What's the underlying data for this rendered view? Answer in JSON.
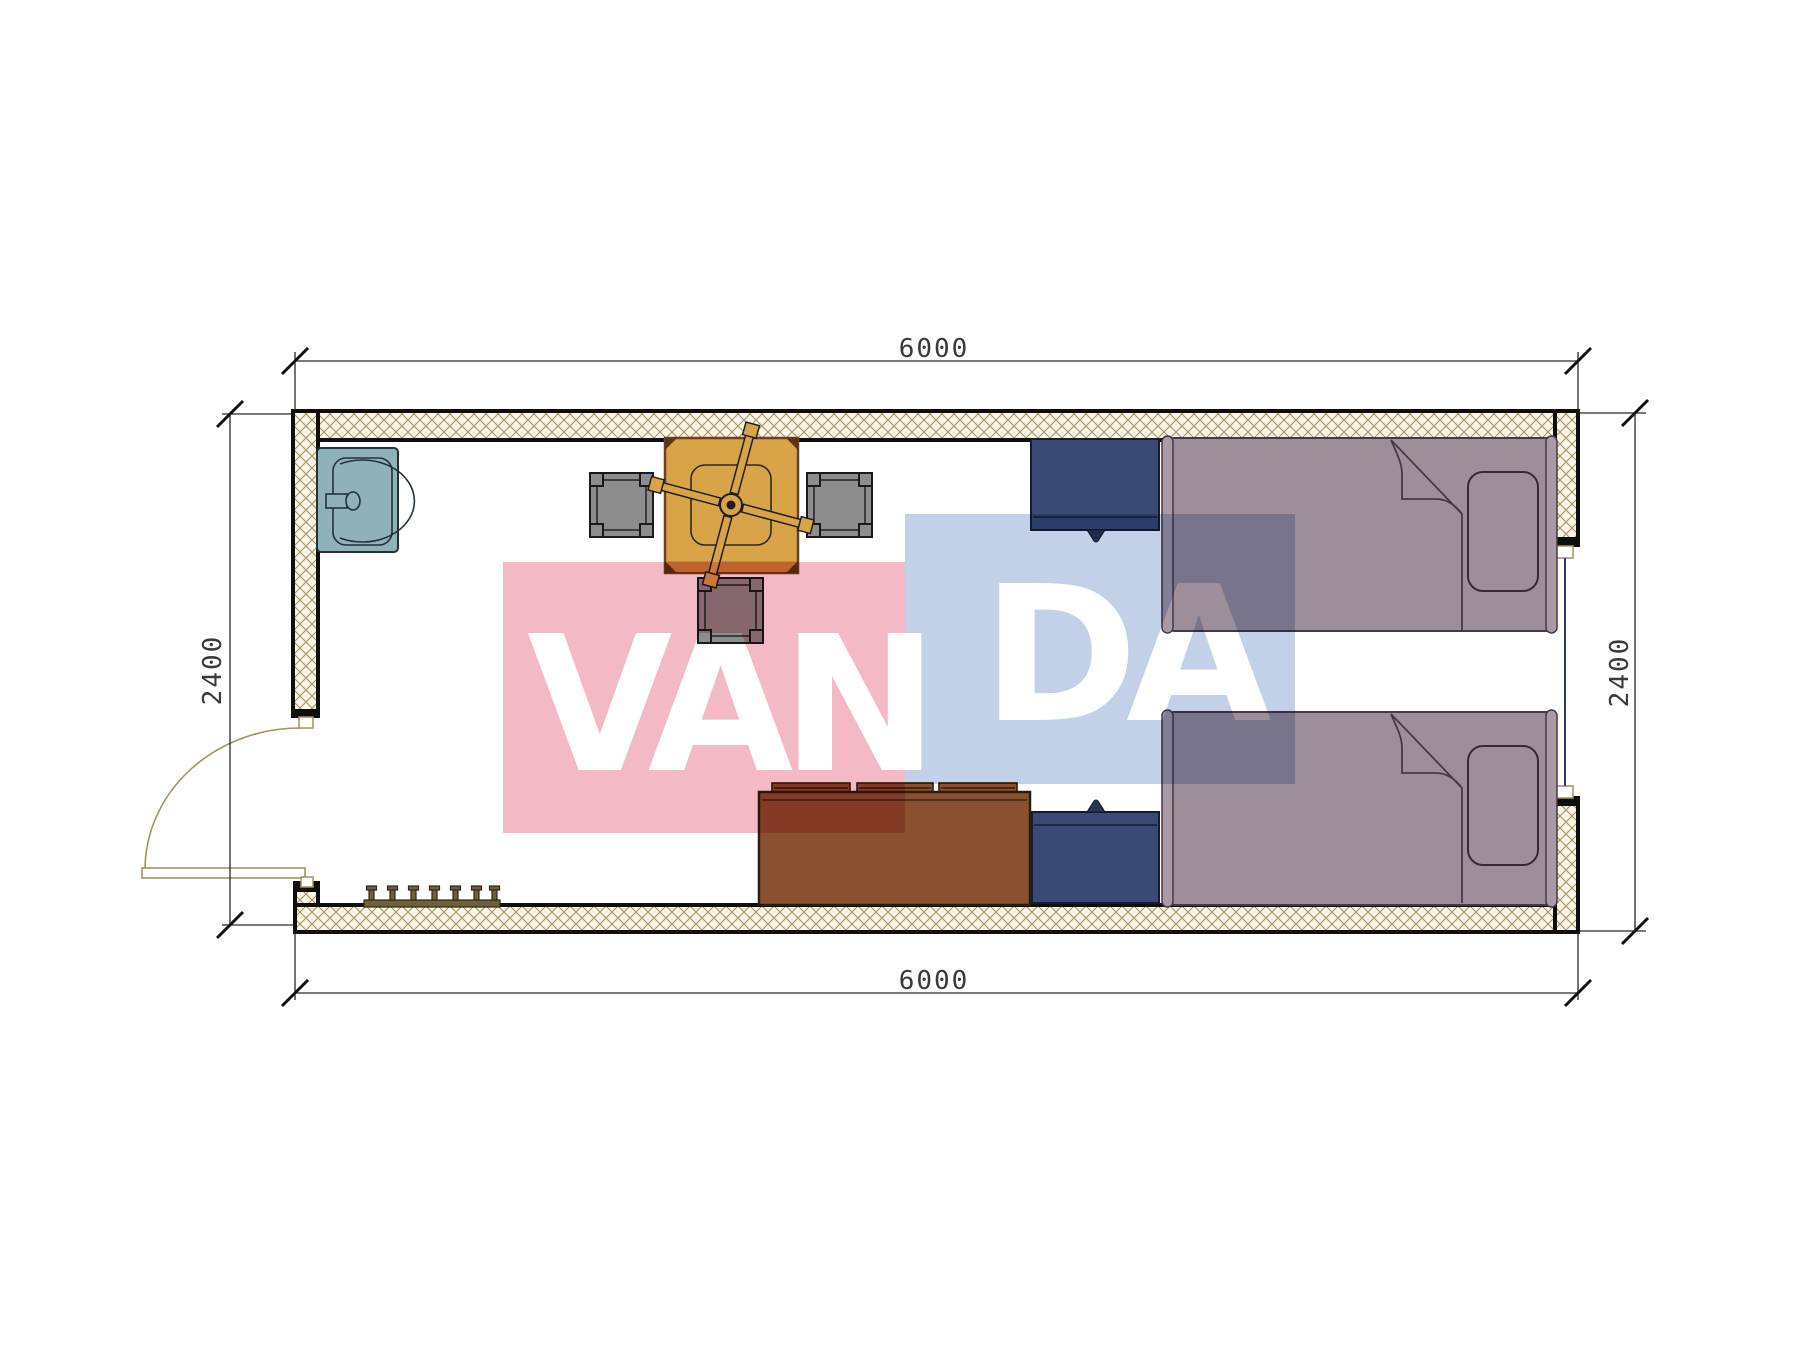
{
  "drawing": {
    "type": "architectural-floor-plan",
    "room": {
      "width_label": "6000",
      "depth_label": "2400"
    },
    "dimensions": {
      "top": "6000",
      "bottom": "6000",
      "left": "2400",
      "right": "2400"
    },
    "watermark": {
      "full_text": "VANDA",
      "text_left": "VAN",
      "text_right": "DA",
      "pink_color": "#f3bac6",
      "blue_color": "#c2d1e7"
    },
    "furniture": {
      "sink": {
        "color": "#8fb1ba"
      },
      "stools": {
        "count": 3,
        "color": "#8d8d8d"
      },
      "table_with_fan": {
        "color": "#d9a348"
      },
      "nightstands": {
        "count": 2,
        "color": "#3a4a75"
      },
      "beds": {
        "count": 2,
        "color": "#9d8e99"
      },
      "sofa": {
        "color": "#8a5130"
      },
      "shoe_rack": {
        "color": "#6f603c"
      }
    },
    "walls": {
      "hatch_line_color": "#a6925e",
      "fill_color": "#faf6ea",
      "outline_color": "#0e0e0e"
    }
  }
}
